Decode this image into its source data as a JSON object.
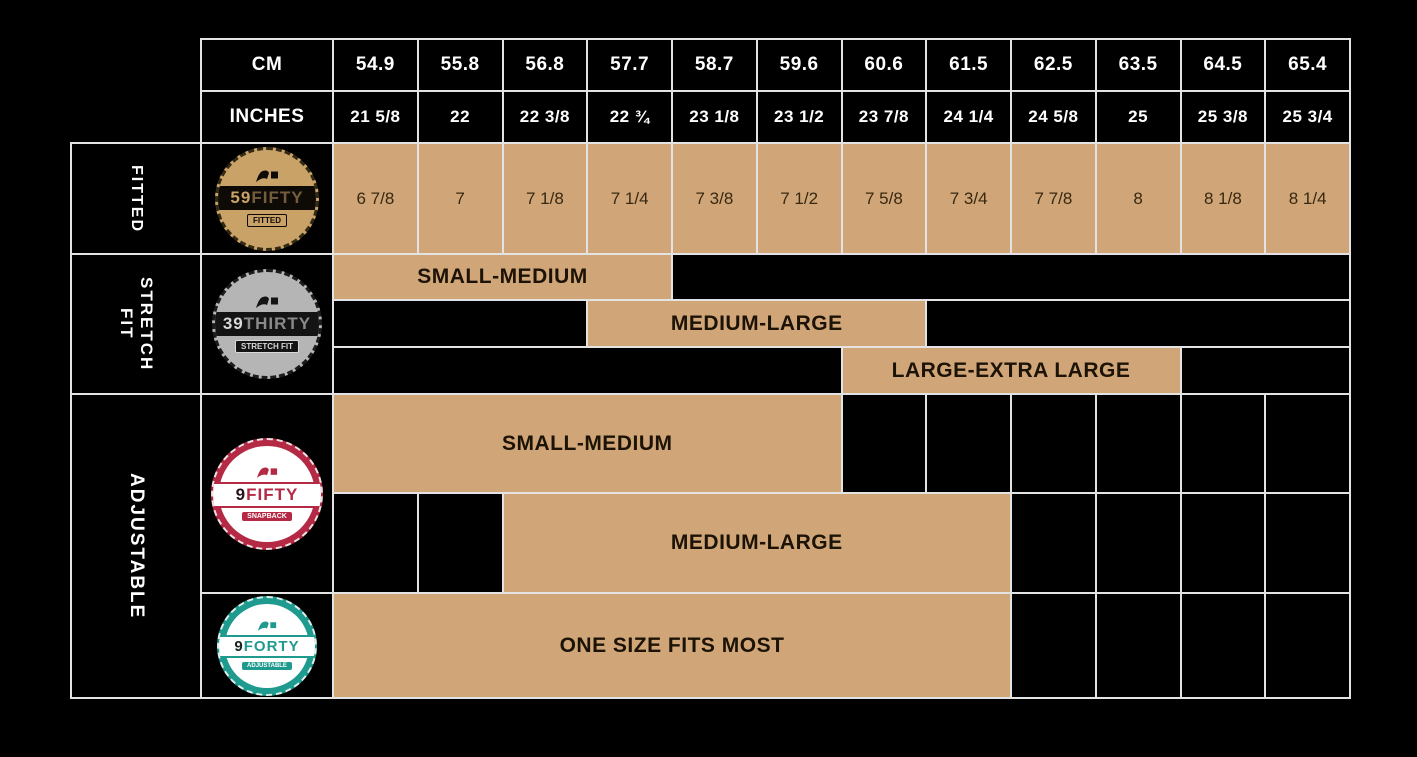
{
  "colors": {
    "background": "#000000",
    "band_tan": "#d0a678",
    "grid_line": "#e3e3e3",
    "header_text": "#ffffff",
    "badge_59fifty": "#c9a268",
    "badge_39thirty": "#b5b5b5",
    "badge_9fifty": "#b42a45",
    "badge_9forty": "#1f9a8e"
  },
  "header": {
    "cm_label": "CM",
    "inches_label": "INCHES",
    "cm_values": [
      "54.9",
      "55.8",
      "56.8",
      "57.7",
      "58.7",
      "59.6",
      "60.6",
      "61.5",
      "62.5",
      "63.5",
      "64.5",
      "65.4"
    ],
    "inches_values": [
      "21 5/8",
      "22",
      "22 3/8",
      "22 ¾",
      "23 1/8",
      "23 1/2",
      "23 7/8",
      "24 1/4",
      "24 5/8",
      "25",
      "25 3/8",
      "25 3/4"
    ]
  },
  "sections": {
    "fitted": {
      "row_label": "FITTED",
      "badge": {
        "num": "59",
        "rest": "FIFTY",
        "sub": "FITTED"
      },
      "sizes": [
        "6 7/8",
        "7",
        "7 1/8",
        "7 1/4",
        "7 3/8",
        "7 1/2",
        "7 5/8",
        "7 3/4",
        "7 7/8",
        "8",
        "8 1/8",
        "8 1/4"
      ]
    },
    "stretch": {
      "row_label_lines": [
        "STRETCH",
        "FIT"
      ],
      "badge": {
        "num": "39",
        "rest": "THIRTY",
        "sub": "STRETCH FIT"
      },
      "bands": [
        {
          "label": "SMALL-MEDIUM",
          "start_col": 1,
          "end_col": 4,
          "cm_from": "54.9",
          "cm_to": "57.7"
        },
        {
          "label": "MEDIUM-LARGE",
          "start_col": 4,
          "end_col": 7,
          "cm_from": "57.7",
          "cm_to": "60.6"
        },
        {
          "label": "LARGE-EXTRA LARGE",
          "start_col": 7,
          "end_col": 10,
          "cm_from": "60.6",
          "cm_to": "63.5"
        }
      ]
    },
    "adjustable": {
      "row_label": "ADJUSTABLE",
      "snapback": {
        "badge": {
          "num": "9",
          "rest": "FIFTY",
          "sub": "SNAPBACK"
        },
        "bands": [
          {
            "label": "SMALL-MEDIUM",
            "start_col": 1,
            "end_col": 6,
            "cm_from": "54.9",
            "cm_to": "59.6"
          },
          {
            "label": "MEDIUM-LARGE",
            "start_col": 3,
            "end_col": 8,
            "cm_from": "56.8",
            "cm_to": "61.5"
          }
        ]
      },
      "onesize": {
        "badge": {
          "num": "9",
          "rest": "FORTY",
          "sub": "ADJUSTABLE"
        },
        "bands": [
          {
            "label": "ONE SIZE FITS MOST",
            "start_col": 1,
            "end_col": 8,
            "cm_from": "54.9",
            "cm_to": "61.5"
          }
        ]
      }
    }
  },
  "chart_data": {
    "type": "table",
    "columns_cm": [
      54.9,
      55.8,
      56.8,
      57.7,
      58.7,
      59.6,
      60.6,
      61.5,
      62.5,
      63.5,
      64.5,
      65.4
    ],
    "columns_inches": [
      "21 5/8",
      "22",
      "22 3/8",
      "22 ¾",
      "23 1/8",
      "23 1/2",
      "23 7/8",
      "24 1/4",
      "24 5/8",
      "25",
      "25 3/8",
      "25 3/4"
    ],
    "rows": [
      {
        "product": "59FIFTY",
        "fit": "FITTED",
        "hat_sizes": [
          "6 7/8",
          "7",
          "7 1/8",
          "7 1/4",
          "7 3/8",
          "7 1/2",
          "7 5/8",
          "7 3/4",
          "7 7/8",
          "8",
          "8 1/8",
          "8 1/4"
        ]
      },
      {
        "product": "39THIRTY",
        "fit": "STRETCH FIT",
        "ranges": [
          {
            "label": "SMALL-MEDIUM",
            "cm_from": 54.9,
            "cm_to": 57.7
          },
          {
            "label": "MEDIUM-LARGE",
            "cm_from": 57.7,
            "cm_to": 60.6
          },
          {
            "label": "LARGE-EXTRA LARGE",
            "cm_from": 60.6,
            "cm_to": 63.5
          }
        ]
      },
      {
        "product": "9FIFTY",
        "fit": "ADJUSTABLE",
        "ranges": [
          {
            "label": "SMALL-MEDIUM",
            "cm_from": 54.9,
            "cm_to": 59.6
          },
          {
            "label": "MEDIUM-LARGE",
            "cm_from": 56.8,
            "cm_to": 61.5
          }
        ]
      },
      {
        "product": "9FORTY",
        "fit": "ADJUSTABLE",
        "ranges": [
          {
            "label": "ONE SIZE FITS MOST",
            "cm_from": 54.9,
            "cm_to": 61.5
          }
        ]
      }
    ]
  }
}
